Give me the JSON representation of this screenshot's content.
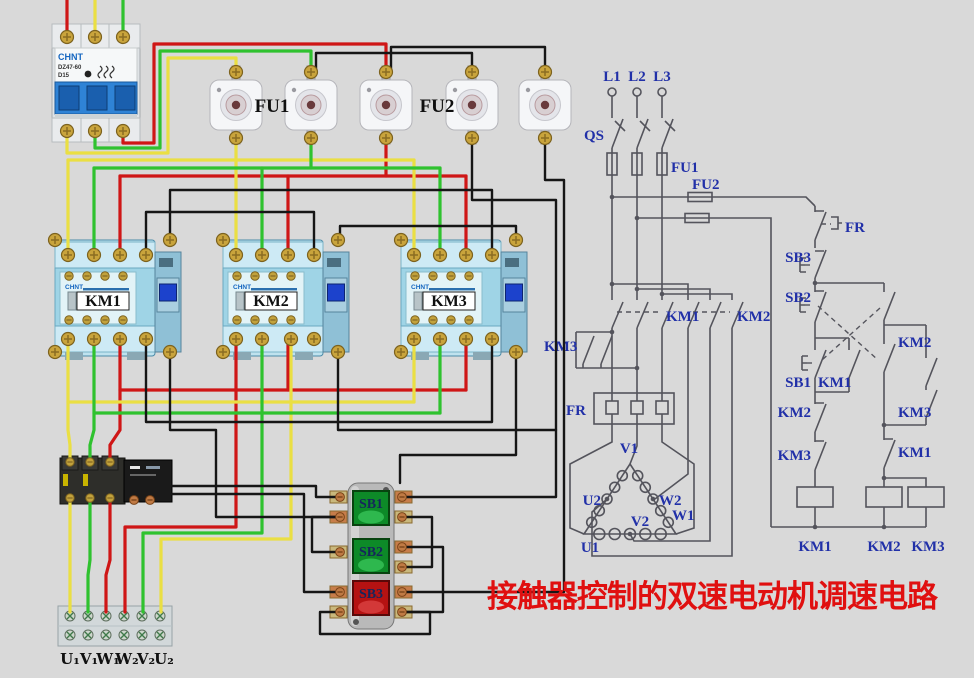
{
  "title": {
    "text": "接触器控制的双速电动机调速电路"
  },
  "colors": {
    "background": "#d9d9d9",
    "title": "#e01010",
    "schematic_ink": "#54545c",
    "schematic_label_blue": "#2130a8",
    "wire_red": "#cf1616",
    "wire_green": "#2fc22f",
    "wire_yellow": "#eadf43",
    "wire_black": "#161616",
    "button_green": "#0d8a28",
    "button_red": "#b51212",
    "contactor_body": "#a9d9e9"
  },
  "panel": {
    "breaker": {
      "brand": "CHNT",
      "model": "DZ47-60",
      "rating": "D15"
    },
    "fuse_group_1": "FU1",
    "fuse_group_2": "FU2",
    "contactors": [
      {
        "brand": "CHNT",
        "label": "KM1"
      },
      {
        "brand": "CHNT",
        "label": "KM2"
      },
      {
        "brand": "CHNT",
        "label": "KM3"
      }
    ],
    "buttons": [
      {
        "label": "SB1"
      },
      {
        "label": "SB2"
      },
      {
        "label": "SB3"
      }
    ],
    "terminals": [
      "U₁",
      "V₁",
      "W₁",
      "W₂",
      "V₂",
      "U₂"
    ]
  },
  "schematic": {
    "phases": {
      "l1": "L1",
      "l2": "L2",
      "l3": "L3"
    },
    "qs": "QS",
    "fu1": "FU1",
    "fu2": "FU2",
    "fr": "FR",
    "sb1": "SB1",
    "sb2": "SB2",
    "sb3": "SB3",
    "km1": "KM1",
    "km2": "KM2",
    "km3": "KM3",
    "motor": {
      "v1": "V1",
      "u2": "U2",
      "w2": "W2",
      "v2": "V2",
      "u1": "U1",
      "w1": "W1"
    }
  }
}
